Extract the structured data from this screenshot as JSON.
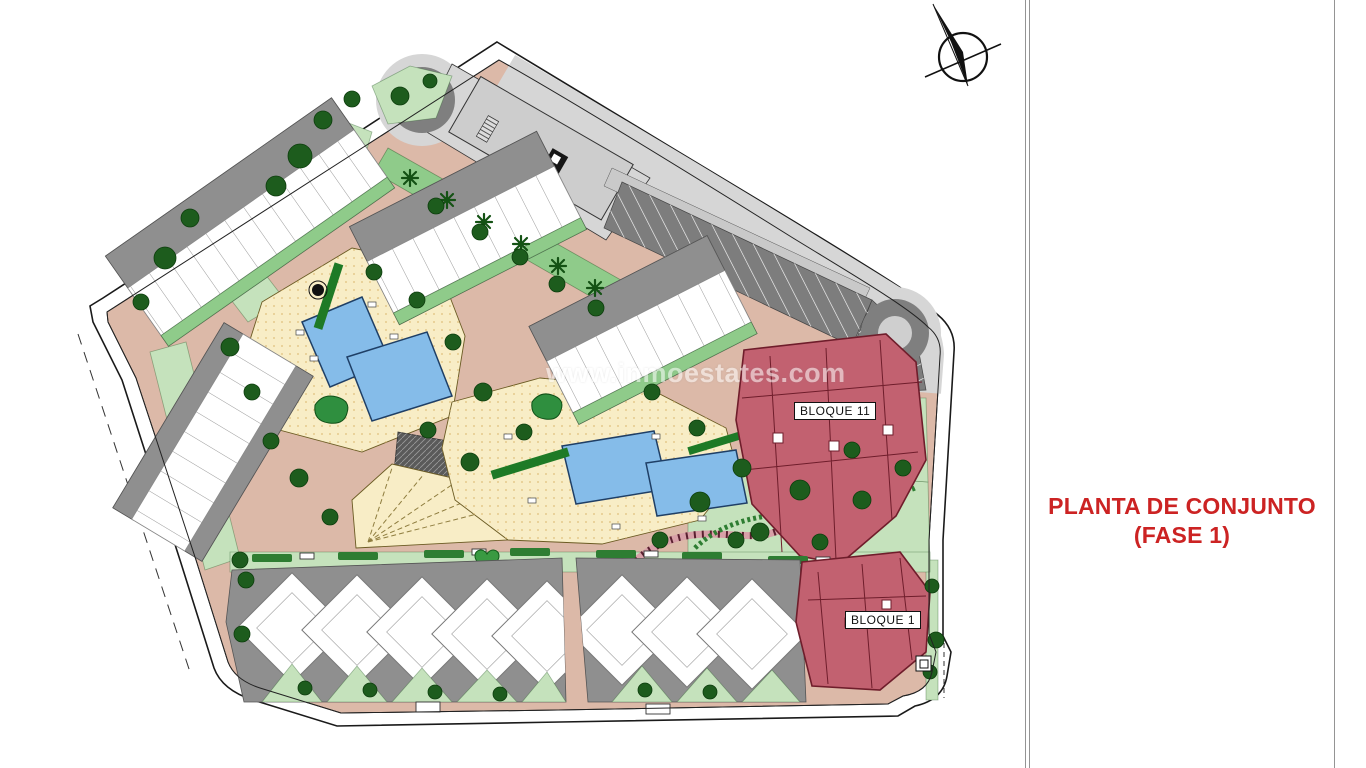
{
  "title": {
    "line1": "PLANTA DE CONJUNTO",
    "line2": "(FASE 1)"
  },
  "plan_labels": {
    "bloque_11": "BLOQUE 11",
    "bloque_1": "BLOQUE 1"
  },
  "watermark": "www.inmoestates.com",
  "icons": {
    "north_arrow": "north-arrow-compass"
  },
  "colors": {
    "road": "#dcb9a8",
    "roadgray": "#d6d6d6",
    "asphalt": "#7d7d7d",
    "park": "#c5e2bc",
    "strip": "#8fcb8a",
    "deck": "#f8edc6",
    "pool": "#85bce9",
    "poolline": "#1f3f66",
    "block": "#c26170",
    "blockline": "#6f1d2b",
    "roof": "#8f8f8f",
    "bldlight": "#c9c9c9",
    "tree": "#1d5c1d",
    "hedge": "#2e7d32",
    "outline": "#1a1a1a",
    "titlered": "#cc2323",
    "watermark": "#ffffff"
  }
}
